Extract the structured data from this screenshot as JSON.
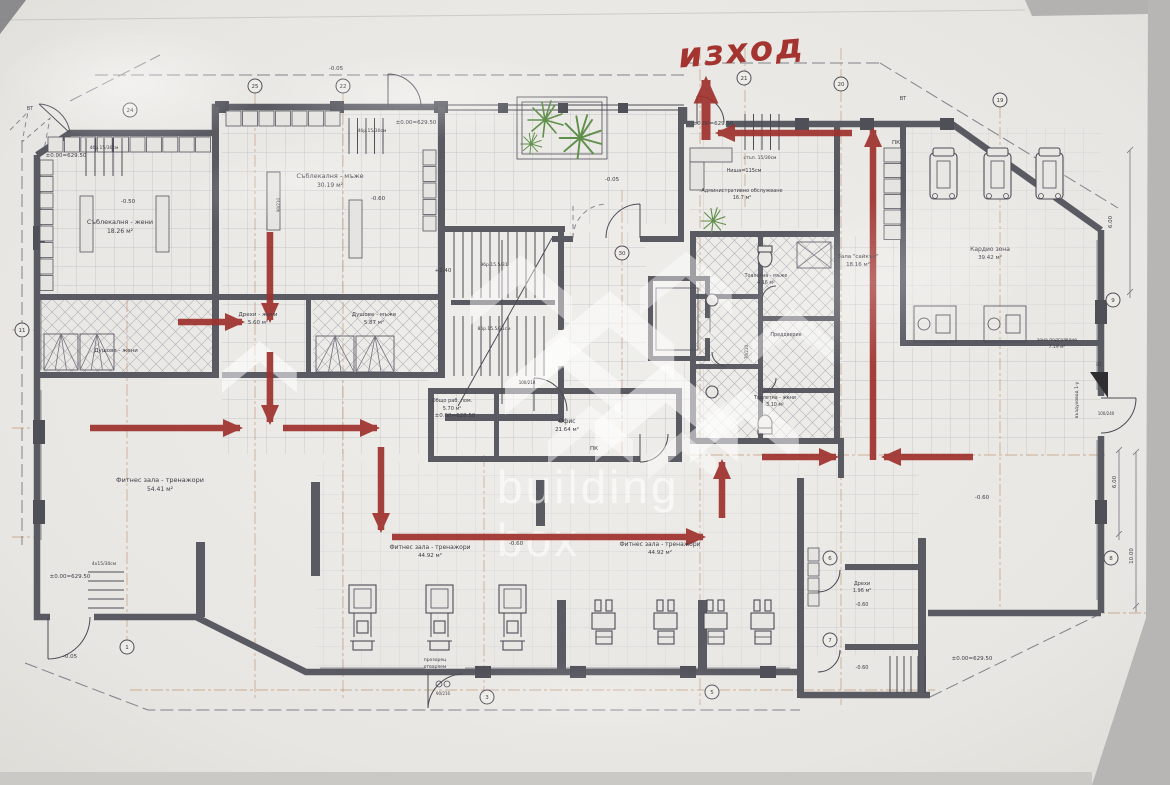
{
  "exit_annotation": {
    "text": "изход"
  },
  "watermark": {
    "line1": "building",
    "line2": "box",
    "marks": [
      {
        "x": 470,
        "y": 240,
        "s": 1.5,
        "o": 0.45
      },
      {
        "x": 545,
        "y": 272,
        "s": 1.9,
        "o": 0.5
      },
      {
        "x": 640,
        "y": 238,
        "s": 1.35,
        "o": 0.42
      },
      {
        "x": 505,
        "y": 318,
        "s": 1.7,
        "o": 0.5
      },
      {
        "x": 595,
        "y": 342,
        "s": 2.1,
        "o": 0.55
      },
      {
        "x": 690,
        "y": 372,
        "s": 1.6,
        "o": 0.5
      },
      {
        "x": 548,
        "y": 393,
        "s": 1.25,
        "o": 0.45
      },
      {
        "x": 648,
        "y": 422,
        "s": 1.0,
        "o": 0.4
      },
      {
        "x": 222,
        "y": 330,
        "s": 1.1,
        "o": 0.55
      },
      {
        "x": 752,
        "y": 296,
        "s": 1.2,
        "o": 0.4
      }
    ]
  },
  "route": {
    "color": "#9e312d",
    "segments": [
      {
        "x1": 706,
        "y1": 140,
        "x2": 706,
        "y2": 80,
        "w": 9
      },
      {
        "x1": 852,
        "y1": 133,
        "x2": 718,
        "y2": 133
      },
      {
        "x1": 873,
        "y1": 460,
        "x2": 873,
        "y2": 130
      },
      {
        "x1": 973,
        "y1": 457,
        "x2": 884,
        "y2": 457
      },
      {
        "x1": 762,
        "y1": 457,
        "x2": 836,
        "y2": 457
      },
      {
        "x1": 722,
        "y1": 518,
        "x2": 722,
        "y2": 462
      },
      {
        "x1": 392,
        "y1": 537,
        "x2": 703,
        "y2": 537
      },
      {
        "x1": 381,
        "y1": 447,
        "x2": 381,
        "y2": 530
      },
      {
        "x1": 283,
        "y1": 428,
        "x2": 377,
        "y2": 428
      },
      {
        "x1": 90,
        "y1": 428,
        "x2": 240,
        "y2": 428
      },
      {
        "x1": 270,
        "y1": 352,
        "x2": 270,
        "y2": 422
      },
      {
        "x1": 178,
        "y1": 322,
        "x2": 242,
        "y2": 322
      },
      {
        "x1": 270,
        "y1": 232,
        "x2": 270,
        "y2": 320
      }
    ]
  },
  "axis_bubbles": [
    {
      "n": "25",
      "x": 255,
      "y": 86
    },
    {
      "n": "22",
      "x": 343,
      "y": 86
    },
    {
      "n": "21",
      "x": 744,
      "y": 78
    },
    {
      "n": "20",
      "x": 841,
      "y": 84
    },
    {
      "n": "19",
      "x": 1000,
      "y": 100
    },
    {
      "n": "24",
      "x": 130,
      "y": 110
    },
    {
      "n": "30",
      "x": 622,
      "y": 253
    },
    {
      "n": "1",
      "x": 127,
      "y": 647
    },
    {
      "n": "3",
      "x": 487,
      "y": 697
    },
    {
      "n": "5",
      "x": 712,
      "y": 692
    },
    {
      "n": "6",
      "x": 830,
      "y": 558
    },
    {
      "n": "7",
      "x": 830,
      "y": 640
    },
    {
      "n": "9",
      "x": 1113,
      "y": 300
    },
    {
      "n": "8",
      "x": 1111,
      "y": 558
    },
    {
      "n": "11",
      "x": 22,
      "y": 330
    }
  ],
  "labels": [
    {
      "t": "Съблекалня - жени",
      "x": 120,
      "y": 224,
      "s": 6.5
    },
    {
      "t": "18.26 м²",
      "x": 120,
      "y": 233,
      "s": 6
    },
    {
      "t": "Съблекалня - мъже",
      "x": 330,
      "y": 178,
      "s": 6.5
    },
    {
      "t": "30.19 м²",
      "x": 330,
      "y": 187,
      "s": 6
    },
    {
      "t": "Душове - жени",
      "x": 116,
      "y": 352,
      "s": 5.5
    },
    {
      "t": "Дрехи - жени",
      "x": 258,
      "y": 316,
      "s": 5.5
    },
    {
      "t": "5.60 м²",
      "x": 258,
      "y": 324,
      "s": 5.5
    },
    {
      "t": "Душове - мъже",
      "x": 374,
      "y": 316,
      "s": 5.5
    },
    {
      "t": "5.87 м²",
      "x": 374,
      "y": 324,
      "s": 5.5
    },
    {
      "t": "Фитнес зала - тренажори",
      "x": 160,
      "y": 482,
      "s": 6.5
    },
    {
      "t": "54.41 м²",
      "x": 160,
      "y": 491,
      "s": 6
    },
    {
      "t": "Фитнес зала - тренажори",
      "x": 430,
      "y": 549,
      "s": 6
    },
    {
      "t": "44.92 м²",
      "x": 430,
      "y": 557,
      "s": 5.5
    },
    {
      "t": "Фитнес зала - тренажори",
      "x": 660,
      "y": 546,
      "s": 6
    },
    {
      "t": "44.92 м²",
      "x": 660,
      "y": 554,
      "s": 5.5
    },
    {
      "t": "Административно обслужване",
      "x": 742,
      "y": 192,
      "s": 5
    },
    {
      "t": "16.7 м²",
      "x": 742,
      "y": 199,
      "s": 5
    },
    {
      "t": "Ниша=115см",
      "x": 744,
      "y": 172,
      "s": 5
    },
    {
      "t": "Зала \"сайкъл\"",
      "x": 858,
      "y": 258,
      "s": 5.5
    },
    {
      "t": "18.16 м²",
      "x": 858,
      "y": 266,
      "s": 5.5
    },
    {
      "t": "Кардио зона",
      "x": 990,
      "y": 251,
      "s": 6
    },
    {
      "t": "39.42 м²",
      "x": 990,
      "y": 259,
      "s": 5.5
    },
    {
      "t": "Тоалетна - мъже",
      "x": 766,
      "y": 277,
      "s": 4.8
    },
    {
      "t": "4.16 м²",
      "x": 766,
      "y": 284,
      "s": 4.8
    },
    {
      "t": "Преддверие",
      "x": 786,
      "y": 336,
      "s": 4.8
    },
    {
      "t": "Тоалетна - жени",
      "x": 775,
      "y": 399,
      "s": 4.8
    },
    {
      "t": "3.10 м²",
      "x": 775,
      "y": 406,
      "s": 4.8
    },
    {
      "t": "Офис",
      "x": 567,
      "y": 423,
      "s": 6
    },
    {
      "t": "21.64 м²",
      "x": 567,
      "y": 431,
      "s": 5.5
    },
    {
      "t": "Общо раб. пом.",
      "x": 452,
      "y": 402,
      "s": 5
    },
    {
      "t": "5.70 м²",
      "x": 452,
      "y": 410,
      "s": 5
    },
    {
      "t": "Дрехи",
      "x": 862,
      "y": 585,
      "s": 5
    },
    {
      "t": "1.96 м²",
      "x": 862,
      "y": 592,
      "s": 5
    },
    {
      "t": "прозорец",
      "x": 435,
      "y": 661,
      "s": 4.5
    },
    {
      "t": "отваряем",
      "x": 435,
      "y": 668,
      "s": 4.5
    },
    {
      "t": "зона подгряване",
      "x": 1057,
      "y": 341,
      "s": 4.5
    },
    {
      "t": "7.19 м²",
      "x": 1057,
      "y": 348,
      "s": 4.5
    },
    {
      "t": "±0.00=629.50",
      "x": 66,
      "y": 157,
      "s": 5.5
    },
    {
      "t": "4бр.15/30см",
      "x": 104,
      "y": 149,
      "s": 4.5
    },
    {
      "t": "±0.00=629.50",
      "x": 416,
      "y": 124,
      "s": 5.5
    },
    {
      "t": "4бр.15/30см",
      "x": 372,
      "y": 132,
      "s": 4.5
    },
    {
      "t": "±0.00=629.50",
      "x": 713,
      "y": 125,
      "s": 5.5
    },
    {
      "t": "стъп. 15/30см",
      "x": 760,
      "y": 159,
      "s": 4.5
    },
    {
      "t": "±0.00=628.50",
      "x": 455,
      "y": 417,
      "s": 5.5
    },
    {
      "t": "±0.00=629.50",
      "x": 70,
      "y": 578,
      "s": 5.5
    },
    {
      "t": "4х15/30см",
      "x": 104,
      "y": 565,
      "s": 4.5
    },
    {
      "t": "±0.00=629.50",
      "x": 972,
      "y": 660,
      "s": 5.5
    },
    {
      "t": "-0.50",
      "x": 128,
      "y": 203,
      "s": 5.5
    },
    {
      "t": "-0.60",
      "x": 378,
      "y": 200,
      "s": 5.5
    },
    {
      "t": "-0.60",
      "x": 516,
      "y": 545,
      "s": 5.5
    },
    {
      "t": "-0.60",
      "x": 982,
      "y": 499,
      "s": 5.5
    },
    {
      "t": "-0.60",
      "x": 862,
      "y": 606,
      "s": 5
    },
    {
      "t": "-0.60",
      "x": 862,
      "y": 669,
      "s": 5
    },
    {
      "t": "-0.05",
      "x": 336,
      "y": 70,
      "s": 5.5
    },
    {
      "t": "-0.05",
      "x": 612,
      "y": 181,
      "s": 5.5
    },
    {
      "t": "-0.05",
      "x": 70,
      "y": 658,
      "s": 5.5
    },
    {
      "t": "+1.40",
      "x": 443,
      "y": 272,
      "s": 5.5
    },
    {
      "t": "9бр.15.5/31",
      "x": 494,
      "y": 266,
      "s": 4.5
    },
    {
      "t": "8бр.15.5/31см",
      "x": 494,
      "y": 330,
      "s": 4.5
    },
    {
      "t": "ПК",
      "x": 594,
      "y": 450,
      "s": 5.5
    },
    {
      "t": "ПК",
      "x": 896,
      "y": 144,
      "s": 5.5
    },
    {
      "t": "ВТ",
      "x": 30,
      "y": 110,
      "s": 5
    },
    {
      "t": "ВТ",
      "x": 903,
      "y": 100,
      "s": 5
    },
    {
      "t": "ВТ",
      "x": 1099,
      "y": 366,
      "s": 4.5
    },
    {
      "t": "100/240",
      "x": 1106,
      "y": 415,
      "s": 4
    },
    {
      "t": "90/210",
      "x": 280,
      "y": 205,
      "s": 4,
      "r": -90
    },
    {
      "t": "100/210",
      "x": 527,
      "y": 384,
      "s": 4
    },
    {
      "t": "70/210",
      "x": 748,
      "y": 352,
      "s": 4,
      "r": -90
    },
    {
      "t": "90/216",
      "x": 443,
      "y": 695,
      "s": 4
    },
    {
      "t": "6.00",
      "x": 1112,
      "y": 222,
      "s": 5.5,
      "r": -90
    },
    {
      "t": "6.00",
      "x": 1116,
      "y": 482,
      "s": 5.5,
      "r": -90
    },
    {
      "t": "10.00",
      "x": 1133,
      "y": 556,
      "s": 5.5,
      "r": -90
    },
    {
      "t": "въздуховод 1-у",
      "x": 1078,
      "y": 400,
      "s": 4.5,
      "r": -90
    }
  ],
  "colors": {
    "axis": "#b07b52",
    "route": "#9e312d",
    "handwriting": "#a43430",
    "plant": "#5f8f4a"
  }
}
